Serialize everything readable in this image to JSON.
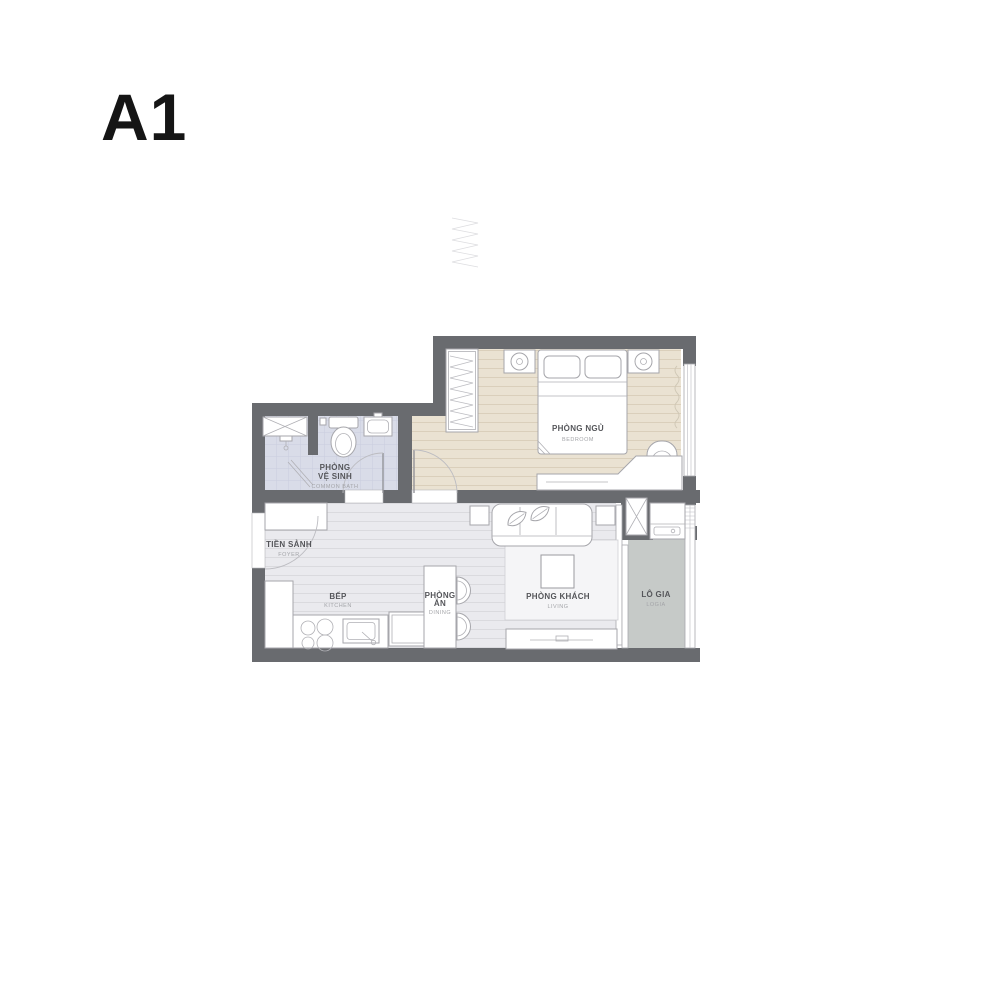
{
  "title": "A1",
  "plan": {
    "rooms": {
      "bedroom": {
        "name": "PHÒNG NGỦ",
        "sub": "BEDROOM"
      },
      "bathroom": {
        "line1": "PHÒNG",
        "line2": "VỆ SINH",
        "sub": "COMMON BATH"
      },
      "foyer": {
        "name": "TIỀN SẢNH",
        "sub": "FOYER"
      },
      "kitchen": {
        "name": "BẾP",
        "sub": "KITCHEN"
      },
      "dining": {
        "line1": "PHÒNG",
        "line2": "ĂN",
        "sub": "DINING"
      },
      "living": {
        "name": "PHÒNG KHÁCH",
        "sub": "LIVING"
      },
      "logia": {
        "name": "LÔ GIA",
        "sub": "LOGIA"
      }
    },
    "colors": {
      "wall": "#696b6f",
      "bedroom_floor": "#eae2d2",
      "bathroom_floor": "#d9dce8",
      "main_floor": "#eaeaee",
      "logia_floor": "#c6cac8",
      "label_text": "#55565a",
      "label_sub_text": "#a3a4a8"
    },
    "furniture_icons": [
      "wardrobe-icon",
      "double-bed-icon",
      "nightstand-lamp-icon",
      "armchair-icon",
      "vanity-desk-icon",
      "shower-tray-icon",
      "shower-head-icon",
      "toilet-icon",
      "washbasin-icon",
      "shoe-cabinet-icon",
      "kitchen-counter-icon",
      "cooktop-icon",
      "kitchen-sink-icon",
      "fridge-icon",
      "dining-table-icon",
      "dining-chair-icon",
      "sofa-icon",
      "leaf-pillow-icon",
      "side-table-icon",
      "coffee-table-icon",
      "rug-icon",
      "tv-cabinet-icon",
      "technical-shaft-icon",
      "washing-machine-icon",
      "door-swing-icon",
      "window-icon",
      "railing-icon"
    ]
  }
}
